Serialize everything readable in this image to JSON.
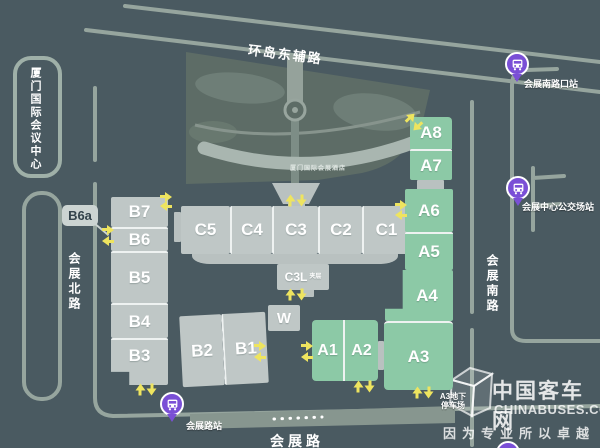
{
  "roads": {
    "top": "环岛东辅路",
    "left": "会展北路",
    "right": "会展南路",
    "bottom": "会展路"
  },
  "venues": {
    "conference_center": "厦门国际会议中心",
    "hotel": "厦门国际会展酒店"
  },
  "halls": {
    "a8": "A8",
    "a7": "A7",
    "a6": "A6",
    "a5": "A5",
    "a4": "A4",
    "a3": "A3",
    "a2": "A2",
    "a1": "A1",
    "b7": "B7",
    "b6": "B6",
    "b6a": "B6a",
    "b5": "B5",
    "b4": "B4",
    "b3": "B3",
    "b2": "B2",
    "b1": "B1",
    "c5": "C5",
    "c4": "C4",
    "c3": "C3",
    "c2": "C2",
    "c1": "C1",
    "c3l": "C3L",
    "c3l_note": "夹层",
    "w": "W"
  },
  "bus_stops": {
    "south_road_stop": "会展南路口站",
    "center_terminal": "会展中心公交场站",
    "exhibition_road_stop": "会展路站"
  },
  "annotations": {
    "parking_line1": "A3地下",
    "parking_line2": "停车场"
  },
  "watermark": {
    "title": "中国客车网",
    "domain": "CHINABUSES.COM",
    "slogan": "因为专业所以卓越"
  },
  "colors": {
    "background": "#4a5a61",
    "hall_gray": "#bfc7c6",
    "hall_green": "#8cc9a6",
    "road": "#96a59e",
    "arrow_yellow": "#eee45f",
    "bus_purple": "#7a4fd6"
  }
}
